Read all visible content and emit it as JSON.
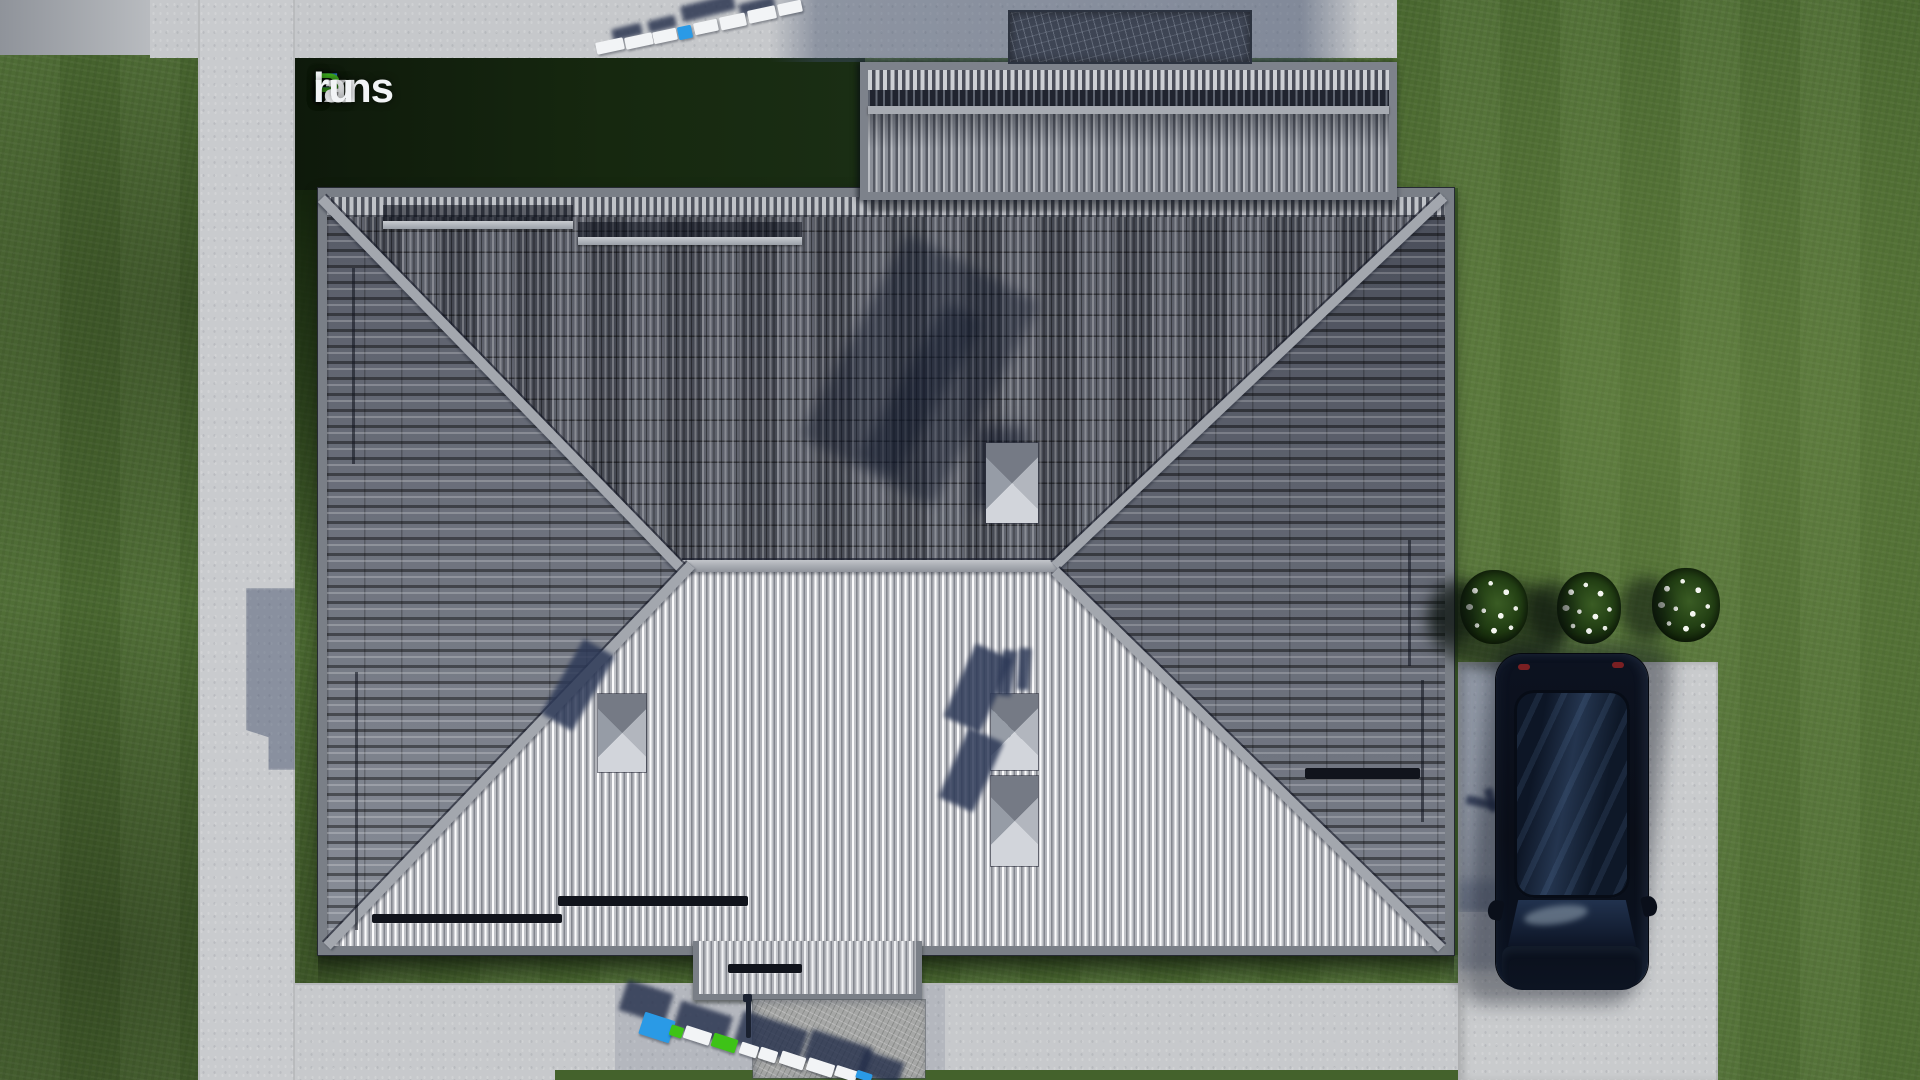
{
  "watermark": {
    "text": "FixPlans.ru",
    "parts": [
      {
        "text": "F",
        "color": "blue"
      },
      {
        "text": "ix",
        "color": "white"
      },
      {
        "text": "P",
        "color": "green"
      },
      {
        "text": "lans",
        "color": "white"
      },
      {
        "text": ".",
        "color": "blue"
      },
      {
        "text": "ru",
        "color": "white"
      }
    ]
  },
  "palette": {
    "logo_blue": "#2e7fe0",
    "logo_green": "#3fae1e",
    "letter_blue": "#2a9ae6",
    "letter_green": "#3ec317",
    "grass": "#4b6a31",
    "grass_shadow": "#16240e",
    "pavement": "#c9cbce",
    "pavement_shadow": "#5a6d92",
    "roof_north": "#525660",
    "roof_south": "#b4b6bb",
    "roof_side": "#666b76",
    "ridge": "#a3a7ae",
    "car_body": "#0b1019"
  },
  "scene": {
    "objects": [
      {
        "cls": "rail-dark-band",
        "name": "roof-hatch-shadow",
        "x": 383,
        "y": 205,
        "w": 190,
        "h": 16
      },
      {
        "cls": "rail-light",
        "name": "snow-rail",
        "x": 383,
        "y": 221,
        "w": 190,
        "h": 8
      },
      {
        "cls": "rail-dark-band",
        "name": "roof-hatch-shadow",
        "x": 578,
        "y": 222,
        "w": 224,
        "h": 15
      },
      {
        "cls": "rail-light",
        "name": "snow-rail",
        "x": 578,
        "y": 237,
        "w": 224,
        "h": 8
      },
      {
        "cls": "rail-vert",
        "name": "snow-rail-vertical",
        "x": 352,
        "y": 268,
        "w": 3,
        "h": 196
      },
      {
        "cls": "rail-vert",
        "name": "snow-rail-vertical",
        "x": 355,
        "y": 672,
        "w": 3,
        "h": 258
      },
      {
        "cls": "rail-vert",
        "name": "snow-rail-vertical",
        "x": 1408,
        "y": 540,
        "w": 3,
        "h": 126
      },
      {
        "cls": "rail-vert",
        "name": "snow-rail-vertical",
        "x": 1421,
        "y": 680,
        "w": 3,
        "h": 142
      },
      {
        "cls": "shadow-soft",
        "name": "roof-soft-shadow",
        "x": 845,
        "y": 255,
        "w": 150,
        "h": 230,
        "rot": 28
      },
      {
        "cls": "shadow-soft",
        "name": "chimney-cast-shadow",
        "x": 900,
        "y": 300,
        "w": 42,
        "h": 180,
        "rot": 30
      },
      {
        "cls": "bar-black",
        "name": "snow-stopper",
        "x": 372,
        "y": 914,
        "w": 190,
        "h": 9
      },
      {
        "cls": "bar-black",
        "name": "snow-stopper",
        "x": 558,
        "y": 896,
        "w": 190,
        "h": 10
      },
      {
        "cls": "bar-black",
        "name": "snow-stopper",
        "x": 1305,
        "y": 768,
        "w": 115,
        "h": 11
      },
      {
        "cls": "bar-black",
        "name": "snow-stopper",
        "x": 728,
        "y": 964,
        "w": 74,
        "h": 9
      },
      {
        "cls": "shadow-navy",
        "name": "chimney-cast-shadow",
        "x": 560,
        "y": 642,
        "w": 36,
        "h": 86,
        "rot": 30
      },
      {
        "cls": "shadow-navy",
        "name": "chimney-cast-shadow",
        "x": 958,
        "y": 648,
        "w": 40,
        "h": 80,
        "rot": 24
      },
      {
        "cls": "shadow-navy",
        "name": "chimney-cast-shadow",
        "x": 952,
        "y": 732,
        "w": 38,
        "h": 76,
        "rot": 24
      },
      {
        "cls": "shadow-navy",
        "name": "vent-pipe",
        "x": 1000,
        "y": 650,
        "w": 14,
        "h": 46,
        "rot": 8
      },
      {
        "cls": "shadow-navy",
        "name": "vent-pipe",
        "x": 1018,
        "y": 648,
        "w": 12,
        "h": 42,
        "rot": 4
      },
      {
        "cls": "lshadow",
        "name": "letter-shadow",
        "x": 681,
        "y": 0,
        "w": 54,
        "h": 16,
        "rot": -14
      },
      {
        "cls": "lshadow",
        "name": "letter-shadow",
        "x": 612,
        "y": 26,
        "w": 30,
        "h": 12,
        "rot": -14
      },
      {
        "cls": "lshadow",
        "name": "letter-shadow",
        "x": 648,
        "y": 18,
        "w": 28,
        "h": 12,
        "rot": -14
      },
      {
        "cls": "lshadow",
        "name": "letter-shadow",
        "x": 739,
        "y": 0,
        "w": 36,
        "h": 12,
        "rot": -14
      },
      {
        "cls": "letter white",
        "name": "letter-block",
        "x": 596,
        "y": 40,
        "w": 28,
        "h": 12,
        "rot": -12
      },
      {
        "cls": "letter white",
        "name": "letter-block",
        "x": 625,
        "y": 35,
        "w": 28,
        "h": 12,
        "rot": -12
      },
      {
        "cls": "letter white",
        "name": "letter-block",
        "x": 653,
        "y": 30,
        "w": 24,
        "h": 12,
        "rot": -12
      },
      {
        "cls": "letter blue",
        "name": "letter-block",
        "x": 678,
        "y": 26,
        "w": 14,
        "h": 13,
        "rot": -12
      },
      {
        "cls": "letter white",
        "name": "letter-block",
        "x": 694,
        "y": 21,
        "w": 24,
        "h": 12,
        "rot": -12
      },
      {
        "cls": "letter white",
        "name": "letter-block",
        "x": 720,
        "y": 15,
        "w": 26,
        "h": 13,
        "rot": -12
      },
      {
        "cls": "letter white",
        "name": "letter-block",
        "x": 748,
        "y": 8,
        "w": 28,
        "h": 13,
        "rot": -12
      },
      {
        "cls": "letter white",
        "name": "letter-block",
        "x": 778,
        "y": 2,
        "w": 24,
        "h": 12,
        "rot": -12
      },
      {
        "cls": "lshadow",
        "name": "letter-shadow",
        "x": 622,
        "y": 986,
        "w": 48,
        "h": 32,
        "rot": 18
      },
      {
        "cls": "lshadow",
        "name": "letter-shadow",
        "x": 676,
        "y": 1008,
        "w": 54,
        "h": 28,
        "rot": 18
      },
      {
        "cls": "lshadow",
        "name": "letter-shadow",
        "x": 737,
        "y": 1020,
        "w": 68,
        "h": 34,
        "rot": 18
      },
      {
        "cls": "lshadow",
        "name": "letter-shadow",
        "x": 806,
        "y": 1038,
        "w": 64,
        "h": 32,
        "rot": 18
      },
      {
        "cls": "lshadow",
        "name": "letter-shadow",
        "x": 860,
        "y": 1056,
        "w": 42,
        "h": 24,
        "rot": 18
      },
      {
        "cls": "pole",
        "name": "porch-post",
        "x": 746,
        "y": 998,
        "w": 5,
        "h": 40
      },
      {
        "cls": "pole",
        "name": "porch-post-cap",
        "x": 743,
        "y": 994,
        "w": 9,
        "h": 8
      },
      {
        "cls": "letter blue",
        "name": "letter-block",
        "x": 641,
        "y": 1016,
        "w": 32,
        "h": 23,
        "rot": 18
      },
      {
        "cls": "letter green",
        "name": "letter-block",
        "x": 670,
        "y": 1026,
        "w": 13,
        "h": 11,
        "rot": 18
      },
      {
        "cls": "letter white",
        "name": "letter-block",
        "x": 684,
        "y": 1029,
        "w": 27,
        "h": 13,
        "rot": 18
      },
      {
        "cls": "letter green",
        "name": "letter-block",
        "x": 712,
        "y": 1036,
        "w": 25,
        "h": 14,
        "rot": 18
      },
      {
        "cls": "letter white",
        "name": "letter-block",
        "x": 740,
        "y": 1044,
        "w": 18,
        "h": 12,
        "rot": 18
      },
      {
        "cls": "letter white",
        "name": "letter-block",
        "x": 759,
        "y": 1049,
        "w": 18,
        "h": 12,
        "rot": 18
      },
      {
        "cls": "letter white",
        "name": "letter-block",
        "x": 780,
        "y": 1054,
        "w": 25,
        "h": 13,
        "rot": 18
      },
      {
        "cls": "letter white",
        "name": "letter-block",
        "x": 807,
        "y": 1061,
        "w": 27,
        "h": 13,
        "rot": 18
      },
      {
        "cls": "letter white",
        "name": "letter-block",
        "x": 835,
        "y": 1068,
        "w": 22,
        "h": 11,
        "rot": 18
      },
      {
        "cls": "letter blue",
        "name": "letter-block",
        "x": 856,
        "y": 1072,
        "w": 16,
        "h": 8,
        "rot": 18
      },
      {
        "cls": "lshadow",
        "name": "lamp-shadow",
        "x": 1466,
        "y": 798,
        "w": 30,
        "h": 9,
        "rot": 12
      },
      {
        "cls": "lshadow",
        "name": "lamp-shadow",
        "x": 1487,
        "y": 788,
        "w": 9,
        "h": 24,
        "rot": -18
      },
      {
        "cls": "blob-dark",
        "name": "car-grass-shadow",
        "x": 1428,
        "y": 580,
        "w": 140,
        "h": 90
      }
    ]
  }
}
